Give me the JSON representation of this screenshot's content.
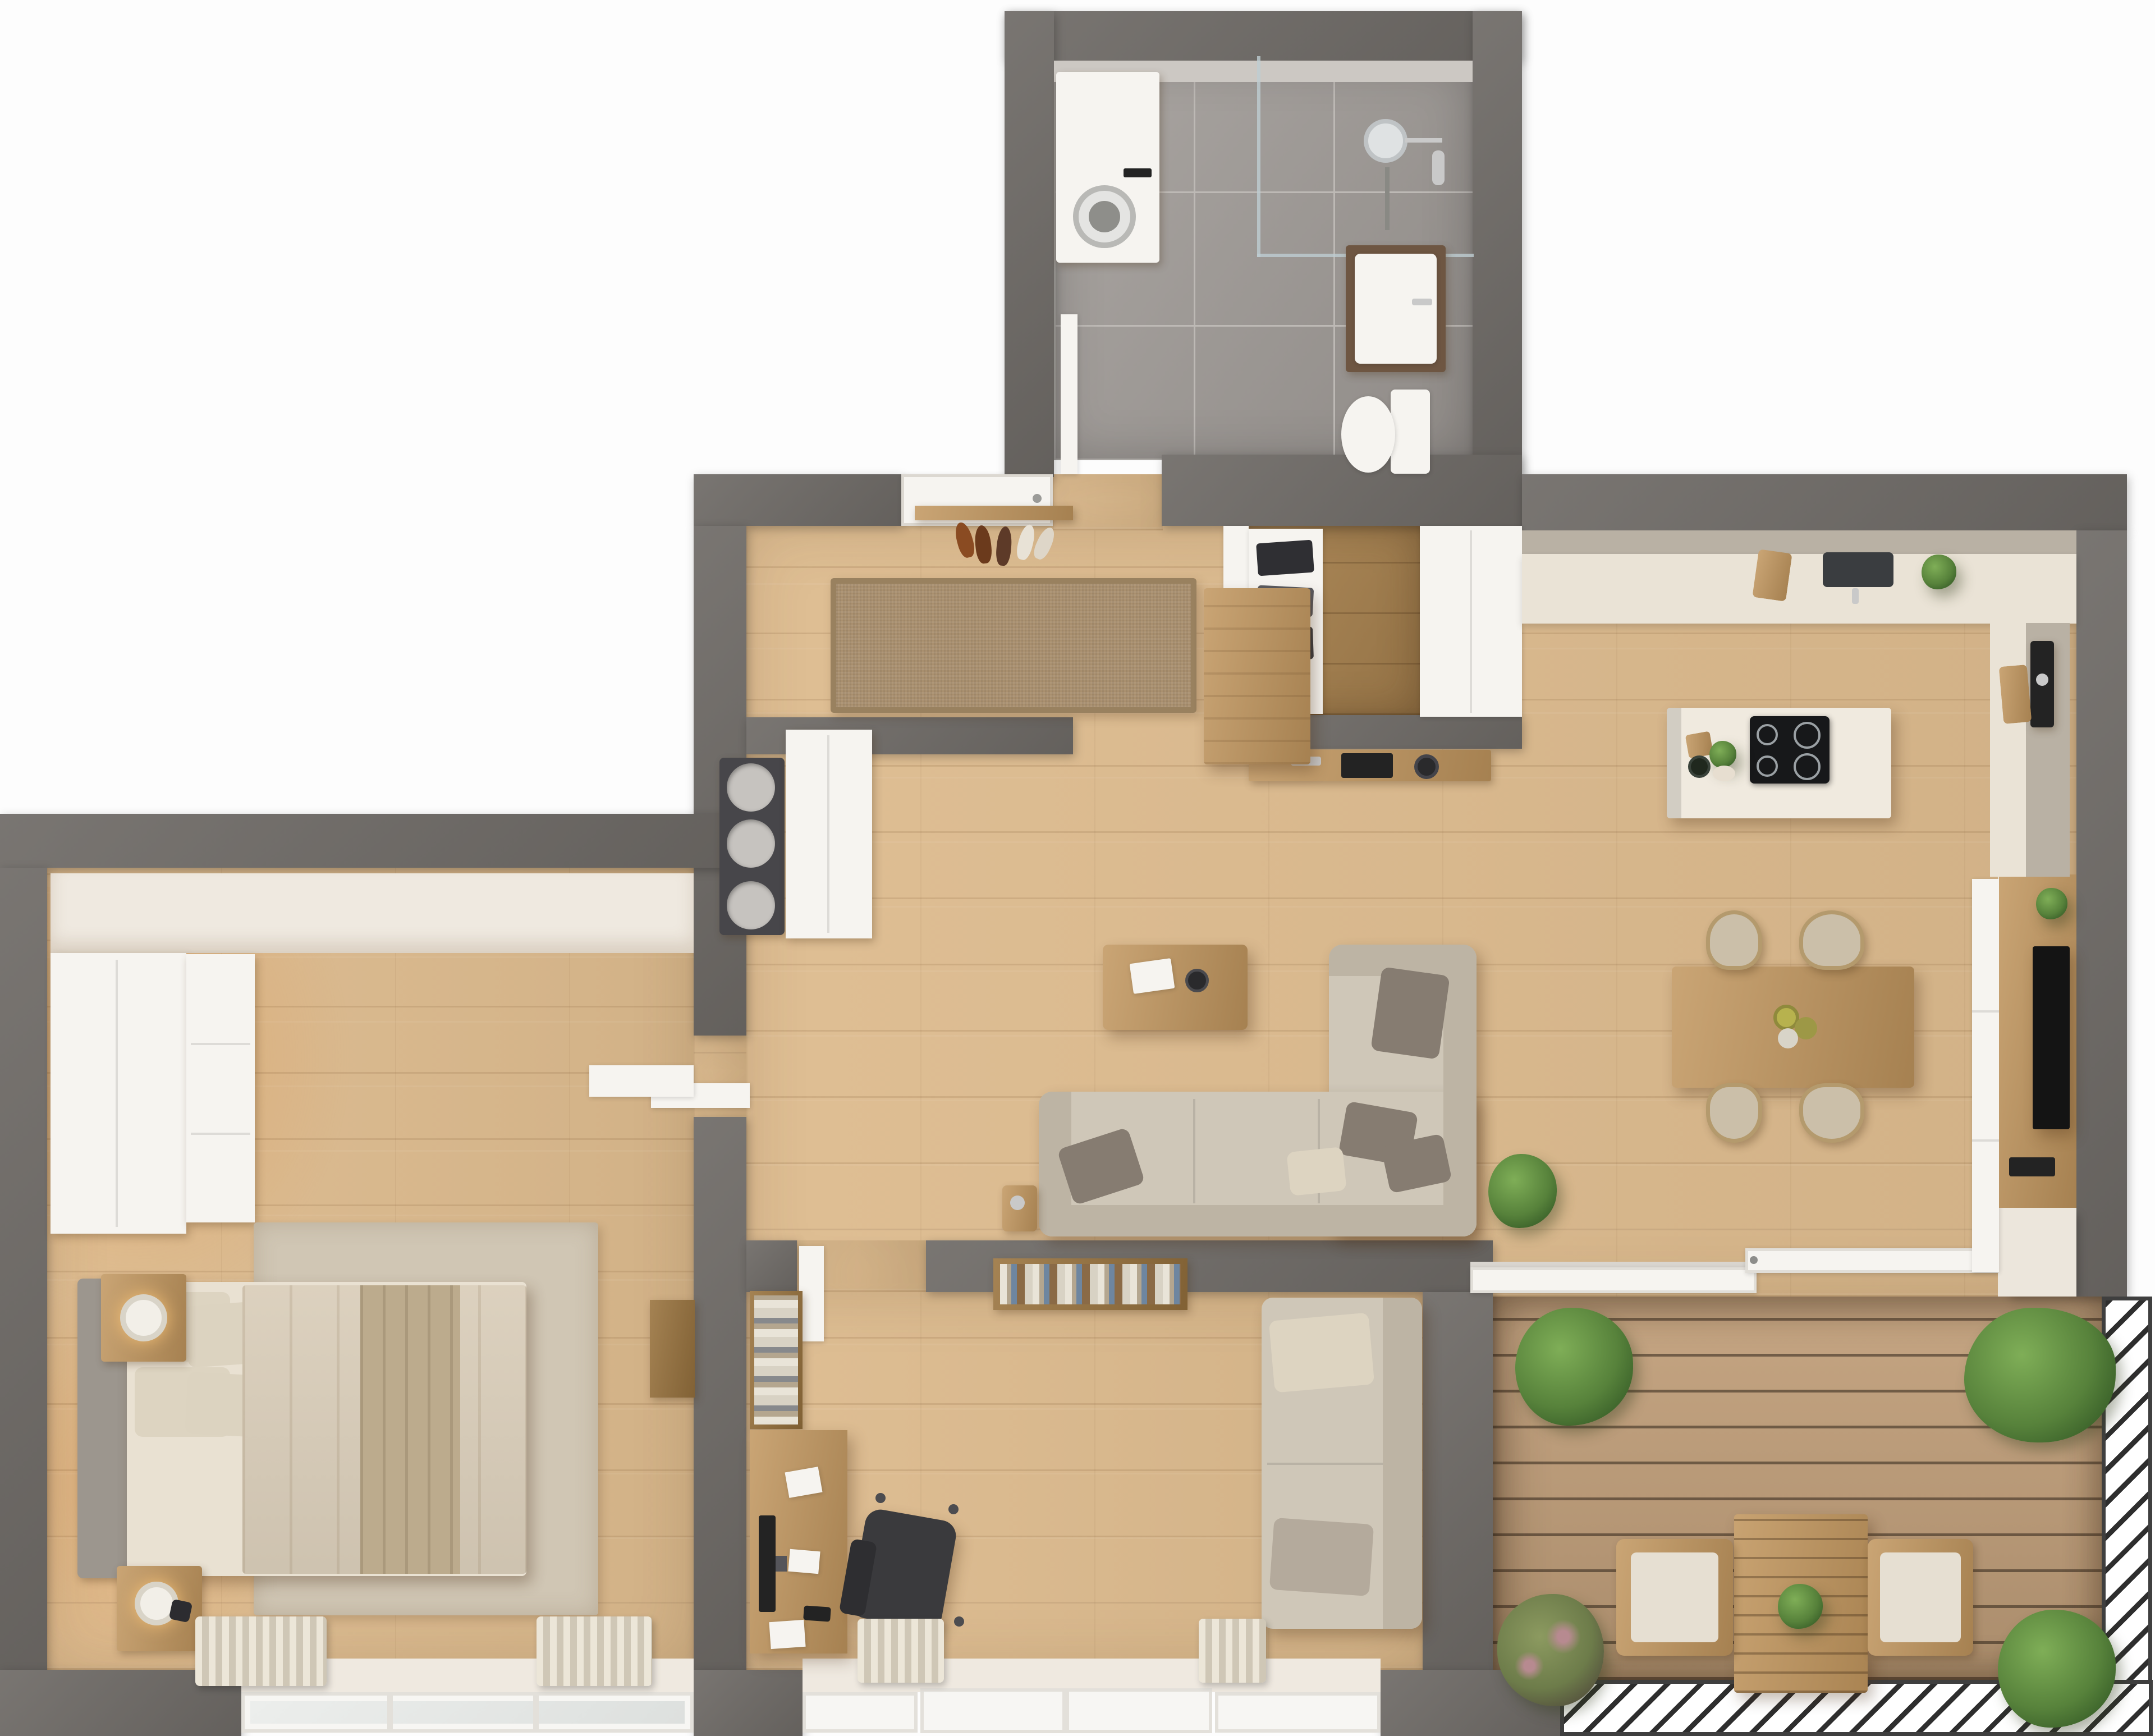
{
  "scene": {
    "kind": "rendered-3d-floor-plan-top-view",
    "rooms": [
      {
        "id": "bathroom",
        "name": "Bathroom",
        "floor": "grey ceramic tile",
        "furniture": [
          "washing-machine",
          "walk-in-shower",
          "shower-head",
          "washbasin-vanity",
          "wall-hung-toilet",
          "bathroom-door"
        ]
      },
      {
        "id": "hallway",
        "name": "Entry Hall",
        "floor": "light oak plank",
        "furniture": [
          "entry-door",
          "woven-rug",
          "shoe-shelf",
          "shoes",
          "wooden-bench",
          "round-knob-cabinet",
          "white-sideboard"
        ]
      },
      {
        "id": "walk-in-closet",
        "name": "Walk-in Closet",
        "floor": "dark oak plank",
        "furniture": [
          "open-shelving-with-clothes",
          "tall-white-cabinet",
          "wooden-console",
          "laptop",
          "round-tray"
        ]
      },
      {
        "id": "kitchen",
        "name": "Kitchen",
        "floor": "light oak plank",
        "furniture": [
          "upper-cabinets",
          "counter-run",
          "sink",
          "cutting-board",
          "counter-plant",
          "right-counter",
          "coffee-machine",
          "leaning-boards",
          "island-with-induction-hob",
          "herbs"
        ]
      },
      {
        "id": "dining",
        "name": "Dining Area",
        "furniture": [
          "wooden-dining-table",
          "four-upholstered-chairs",
          "table-centerpiece"
        ]
      },
      {
        "id": "living",
        "name": "Living Room",
        "furniture": [
          "l-shaped-beige-sofa",
          "throw-pillows",
          "wooden-coffee-table",
          "book",
          "bowl",
          "side-table",
          "potted-plant",
          "tv-media-wall",
          "television",
          "media-device"
        ]
      },
      {
        "id": "bedroom",
        "name": "Bedroom",
        "furniture": [
          "double-bed",
          "grey-headboard",
          "pillows",
          "duvet",
          "throw-blanket",
          "two-nightstands",
          "table-lamps",
          "built-in-wardrobe",
          "drawer-column",
          "wall-shelf",
          "dresser",
          "area-rug",
          "curtains",
          "window"
        ]
      },
      {
        "id": "office",
        "name": "Home Office",
        "furniture": [
          "desk",
          "monitor",
          "office-chair",
          "bookshelf",
          "wall-book-shelf",
          "daybed-sofa",
          "curtains",
          "french-doors"
        ]
      },
      {
        "id": "balcony",
        "name": "Balcony Terrace",
        "floor": "wood decking",
        "furniture": [
          "bistro-table",
          "two-cushion-chairs",
          "potted-plants",
          "diagonal-slat-railing",
          "sliding-glass-door"
        ]
      }
    ]
  },
  "colors": {
    "wall": "#6f6b67",
    "white": "#f6f4f0",
    "finish": "#efe9e0",
    "wood": "#ddbb8e",
    "woodDark": "#a8824f",
    "tile": "#a09b97",
    "grout": "#bdb9b5",
    "deck": "#c2a07b",
    "rail": "#2e2e2e",
    "fwood": "#c1965e",
    "fwoodDark": "#9a743f",
    "sofa": "#cfc7b8",
    "sofaShade": "#bdb4a4",
    "cushion": "#867c71",
    "pillow": "#ddd4c1",
    "rug": "#a98f6e",
    "rugBedroom": "#d0c6b4",
    "duvet": "#d9cdb9",
    "blanket": "#bcab8d",
    "chair": "#cbbfa9",
    "island": "#f0eadf",
    "counter": "#eae3d6",
    "counterFront": "#b9b1a4",
    "hob": "#17181a",
    "tv": "#141414",
    "plant": "#57823b",
    "plantLight": "#7fae57",
    "black": "#232323",
    "metal": "#c9c9c9"
  }
}
